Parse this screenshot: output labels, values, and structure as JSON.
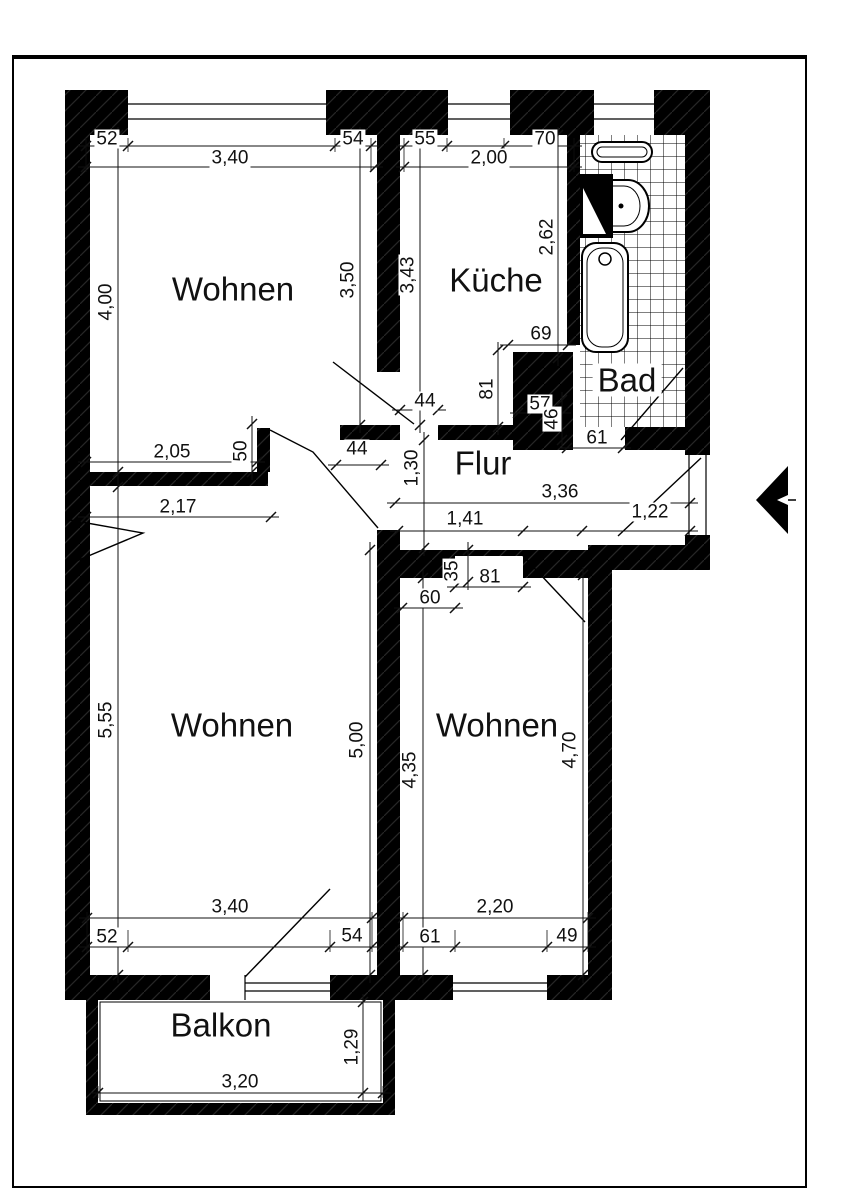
{
  "rooms": {
    "wohnen_top": "Wohnen",
    "kueche": "Küche",
    "bad": "Bad",
    "flur": "Flur",
    "wohnen_left": "Wohnen",
    "wohnen_right": "Wohnen",
    "balkon": "Balkon"
  },
  "labels": {
    "t52": "52",
    "t340": "3,40",
    "t54": "54",
    "t55": "55",
    "t200": "2,00",
    "t70": "70",
    "v400": "4,00",
    "v350": "3,50",
    "v343": "3,43",
    "v262": "2,62",
    "m205": "2,05",
    "m50": "50",
    "m44a": "44",
    "m44k": "44",
    "m69": "69",
    "m81a": "81",
    "m57": "57",
    "m46": "46",
    "m61": "61",
    "m130": "1,30",
    "m336": "3,36",
    "m141": "1,41",
    "m122": "1,22",
    "m217": "2,17",
    "m35": "35",
    "m81b": "81",
    "m60": "60",
    "v555": "5,55",
    "v500": "5,00",
    "v435": "4,35",
    "v470": "4,70",
    "b340": "3,40",
    "b52": "52",
    "b54": "54",
    "b220": "2,20",
    "b61": "61",
    "b49": "49",
    "bal320": "3,20",
    "bal129": "1,29"
  },
  "icons": {
    "entrance_arrow": "left-filled-triangle"
  },
  "colors": {
    "wall": "#000000",
    "line": "#111111",
    "paper": "#ffffff"
  }
}
